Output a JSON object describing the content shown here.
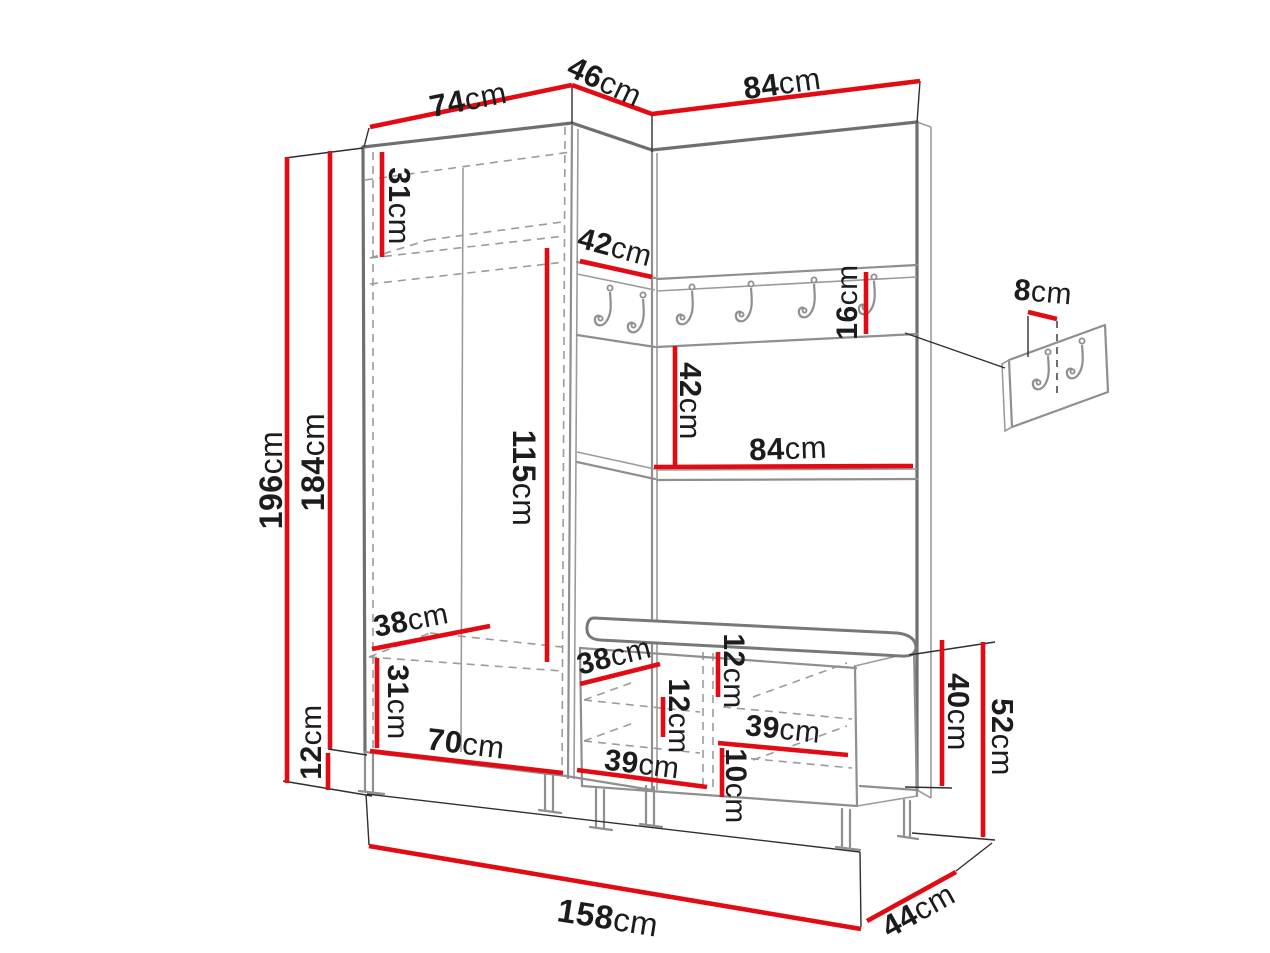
{
  "diagram_type": "furniture-dimension-diagram",
  "subject": "hallway wardrobe set with coat hook rail, shelf panel and shoe bench",
  "unit": "cm",
  "colors": {
    "background": "#ffffff",
    "dimension_line": "#e30b13",
    "label_text": "#1c1c1c",
    "furniture_outline": "#6f6f6f",
    "furniture_line": "#8f8f8f"
  },
  "hook_counts": {
    "rail_hooks": 6,
    "wall_panel_hooks": 2
  },
  "dimensions": [
    {
      "id": "wardrobe-top-width",
      "value": "74",
      "unit": "cm"
    },
    {
      "id": "corner-top-depth",
      "value": "46",
      "unit": "cm"
    },
    {
      "id": "panel-top-width",
      "value": "84",
      "unit": "cm"
    },
    {
      "id": "top-shelf-height",
      "value": "31",
      "unit": "cm"
    },
    {
      "id": "total-height",
      "value": "196",
      "unit": "cm"
    },
    {
      "id": "carcass-height",
      "value": "184",
      "unit": "cm"
    },
    {
      "id": "hanging-space-height",
      "value": "115",
      "unit": "cm"
    },
    {
      "id": "wardrobe-shelf-depth",
      "value": "38",
      "unit": "cm"
    },
    {
      "id": "bottom-shelf-height",
      "value": "31",
      "unit": "cm"
    },
    {
      "id": "wardrobe-bottom-width",
      "value": "70",
      "unit": "cm"
    },
    {
      "id": "base-leg-height",
      "value": "12",
      "unit": "cm"
    },
    {
      "id": "corner-shelf-depth",
      "value": "42",
      "unit": "cm"
    },
    {
      "id": "hook-rail-height",
      "value": "16",
      "unit": "cm"
    },
    {
      "id": "panel-shelf-drop",
      "value": "42",
      "unit": "cm"
    },
    {
      "id": "panel-shelf-width",
      "value": "84",
      "unit": "cm"
    },
    {
      "id": "bench-shelf-depth",
      "value": "38",
      "unit": "cm"
    },
    {
      "id": "bench-top-height",
      "value": "12",
      "unit": "cm"
    },
    {
      "id": "bench-inner-shelf-height",
      "value": "12",
      "unit": "cm"
    },
    {
      "id": "bench-right-width",
      "value": "39",
      "unit": "cm"
    },
    {
      "id": "bench-plinth-height",
      "value": "10",
      "unit": "cm"
    },
    {
      "id": "bench-left-width",
      "value": "39",
      "unit": "cm"
    },
    {
      "id": "bench-carcass-height",
      "value": "40",
      "unit": "cm"
    },
    {
      "id": "bench-total-height",
      "value": "52",
      "unit": "cm"
    },
    {
      "id": "total-width",
      "value": "158",
      "unit": "cm"
    },
    {
      "id": "bench-depth",
      "value": "44",
      "unit": "cm"
    },
    {
      "id": "wall-panel-hook-offset",
      "value": "8",
      "unit": "cm"
    }
  ]
}
